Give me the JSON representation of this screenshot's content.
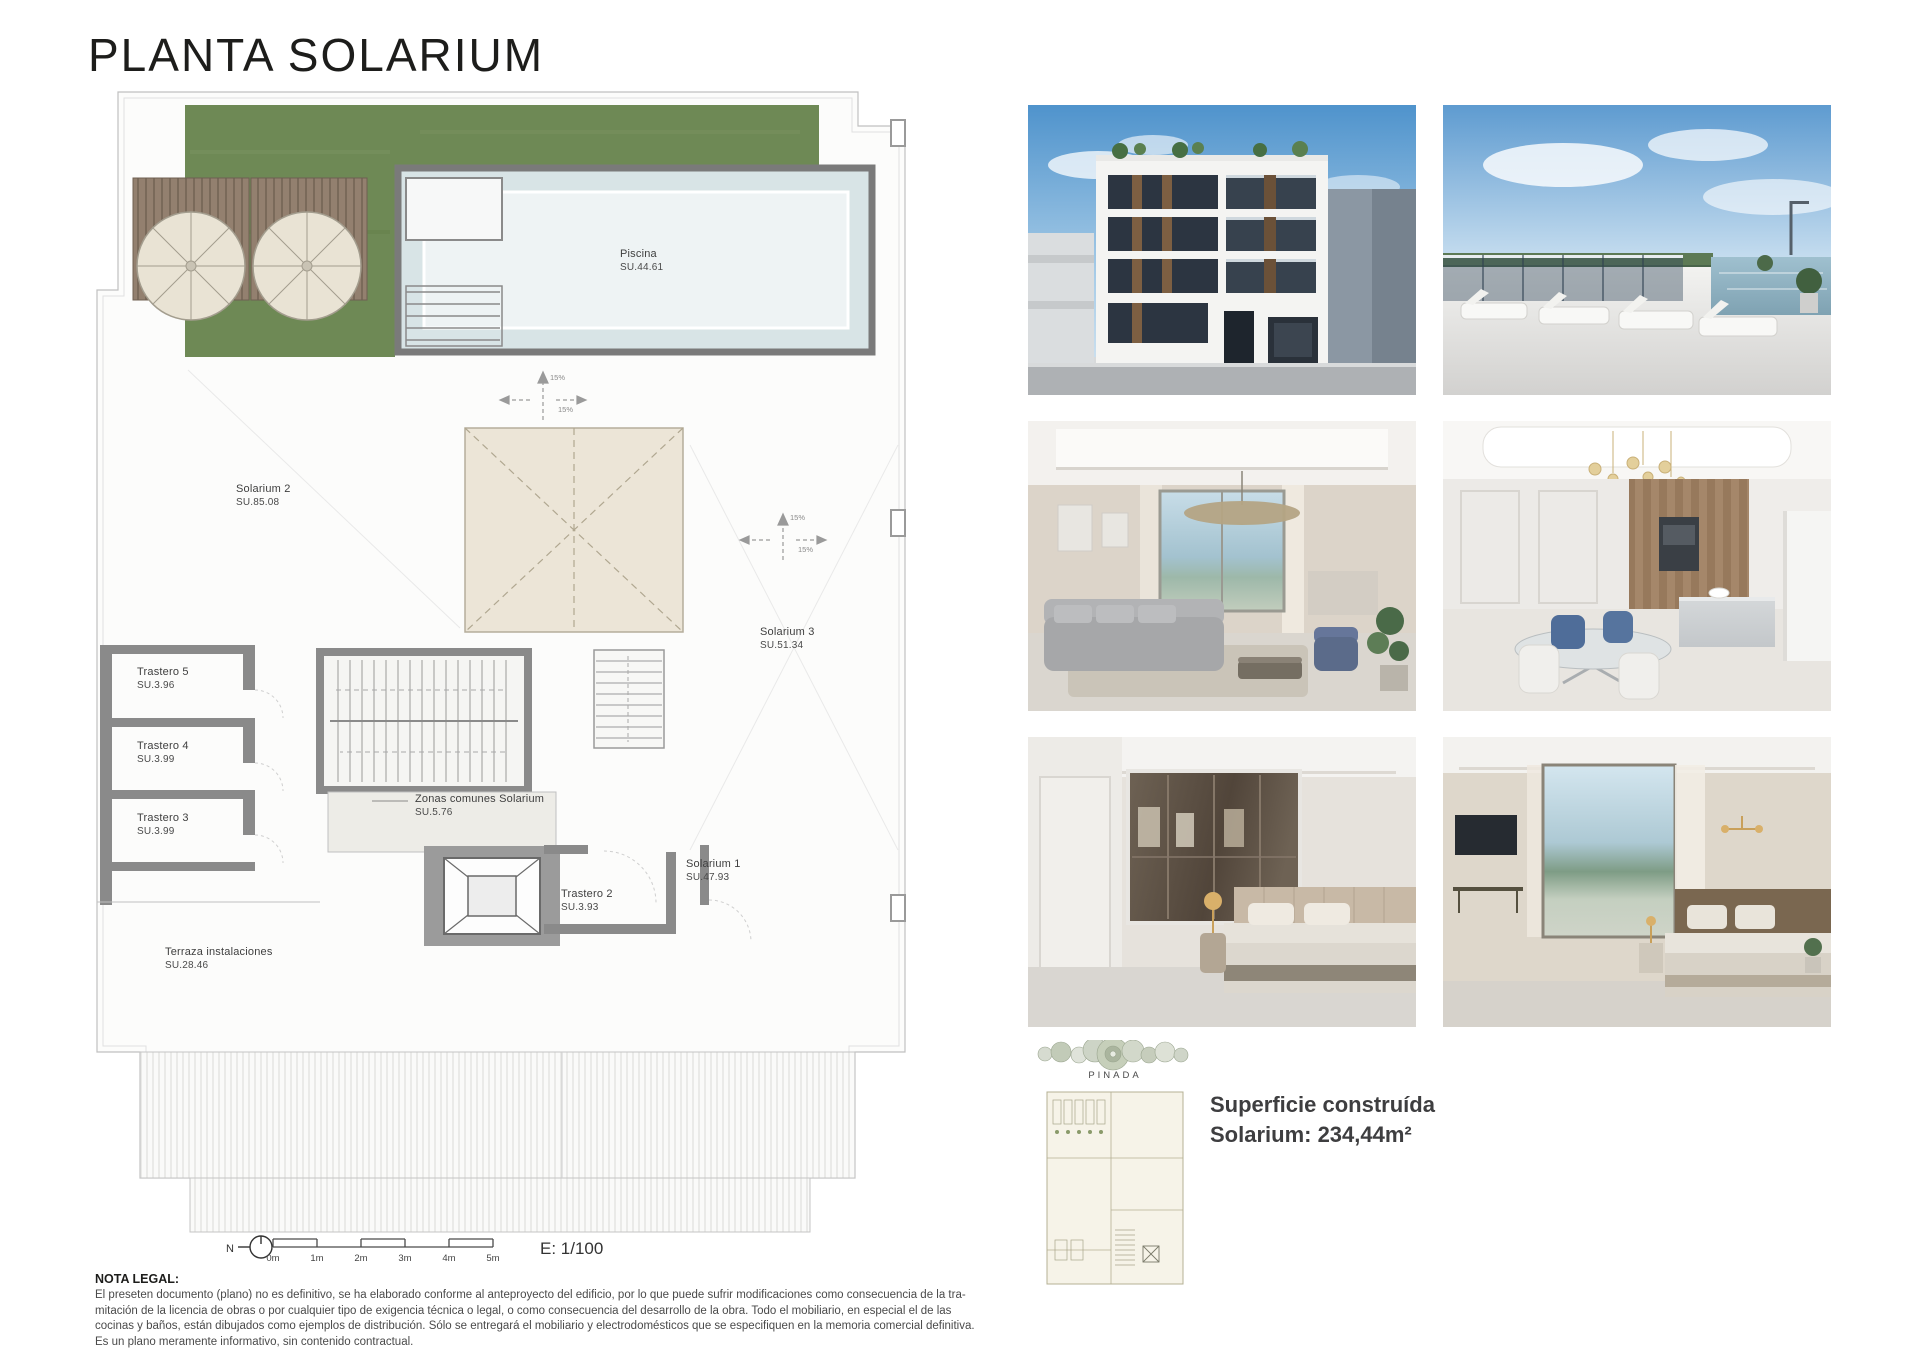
{
  "page": {
    "title": "PLANTA SOLARIUM"
  },
  "plan": {
    "rooms": [
      {
        "name": "Piscina",
        "area": "SU.44.61"
      },
      {
        "name": "Solarium 2",
        "area": "SU.85.08"
      },
      {
        "name": "Solarium 3",
        "area": "SU.51.34"
      },
      {
        "name": "Trastero 5",
        "area": "SU.3.96"
      },
      {
        "name": "Trastero 4",
        "area": "SU.3.99"
      },
      {
        "name": "Trastero 3",
        "area": "SU.3.99"
      },
      {
        "name": "Zonas comunes Solarium",
        "area": "SU.5.76"
      },
      {
        "name": "Trastero 2",
        "area": "SU.3.93"
      },
      {
        "name": "Solarium 1",
        "area": "SU.47.93"
      },
      {
        "name": "Terraza instalaciones",
        "area": "SU.28.46"
      }
    ],
    "slope_label": "15%",
    "north_label": "N",
    "scale_ticks": [
      "0m",
      "1m",
      "2m",
      "3m",
      "4m",
      "5m"
    ],
    "scale_text": "E: 1/100"
  },
  "site_plan": {
    "label": "PINADA"
  },
  "summary": {
    "line1": "Superficie construída",
    "line2": "Solarium: 234,44m²"
  },
  "legal": {
    "heading": "NOTA LEGAL:",
    "body": "El preseten documento (plano) no es definitivo, se ha elaborado conforme al anteproyecto del edificio, por lo que puede sufrir modificaciones como consecuencia de la tra-\nmitación de la licencia de obras o por cualquier tipo de exigencia técnica o legal, o como consecuencia del desarrollo de la obra. Todo el mobiliario, en especial el de las\ncocinas y baños, están dibujados como ejemplos de distribución. Sólo se entregará el mobiliario y electrodomésticos que se especifiquen en la memoria comercial definitiva.\nEs un plano meramente informativo, sin contenido contractual."
  },
  "photos": [
    {
      "name": "building-exterior-render"
    },
    {
      "name": "rooftop-pool-terrace-render"
    },
    {
      "name": "living-room-render"
    },
    {
      "name": "dining-kitchen-render"
    },
    {
      "name": "bedroom-wardrobe-render"
    },
    {
      "name": "bedroom-window-render"
    }
  ],
  "colors": {
    "lawn_green": "#6e8955",
    "wall_gray": "#8a8a8a",
    "pool_blue": "#d8e4e6",
    "skylight_beige": "#ece5d7",
    "title_text": "#1d1d1b"
  }
}
